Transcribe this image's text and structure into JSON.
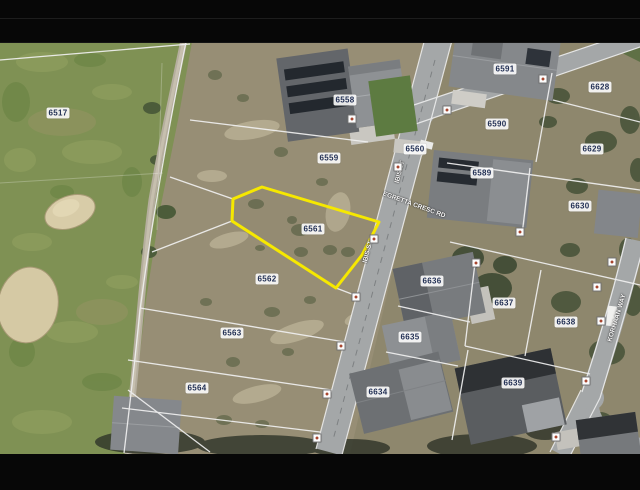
{
  "map": {
    "type": "aerial-parcel-view",
    "highlighted_parcel": "6561",
    "parcels": [
      {
        "id": "6517",
        "x": 58,
        "y": 113
      },
      {
        "id": "6558",
        "x": 345,
        "y": 100
      },
      {
        "id": "6559",
        "x": 329,
        "y": 158
      },
      {
        "id": "6560",
        "x": 415,
        "y": 149
      },
      {
        "id": "6561",
        "x": 313,
        "y": 229,
        "highlighted": true
      },
      {
        "id": "6562",
        "x": 267,
        "y": 279
      },
      {
        "id": "6563",
        "x": 232,
        "y": 333
      },
      {
        "id": "6564",
        "x": 197,
        "y": 388
      },
      {
        "id": "6589",
        "x": 482,
        "y": 173
      },
      {
        "id": "6590",
        "x": 497,
        "y": 124
      },
      {
        "id": "6591",
        "x": 505,
        "y": 69
      },
      {
        "id": "6628",
        "x": 600,
        "y": 87
      },
      {
        "id": "6629",
        "x": 592,
        "y": 149
      },
      {
        "id": "6630",
        "x": 580,
        "y": 206
      },
      {
        "id": "6634",
        "x": 378,
        "y": 392
      },
      {
        "id": "6635",
        "x": 410,
        "y": 337
      },
      {
        "id": "6636",
        "x": 432,
        "y": 281
      },
      {
        "id": "6637",
        "x": 504,
        "y": 303
      },
      {
        "id": "6638",
        "x": 566,
        "y": 322
      },
      {
        "id": "6639",
        "x": 513,
        "y": 383
      }
    ],
    "street_labels": [
      {
        "text": "EGRETTA CRESC RD",
        "x": 414,
        "y": 205,
        "angle": 20
      },
      {
        "text": "IBIS ST",
        "x": 400,
        "y": 172,
        "angle": -75
      },
      {
        "text": "IBIS ST",
        "x": 368,
        "y": 252,
        "angle": -75
      },
      {
        "text": "KORHAAN WAY",
        "x": 617,
        "y": 318,
        "angle": -73
      }
    ],
    "road_markers": [
      {
        "x": 352,
        "y": 119
      },
      {
        "x": 398,
        "y": 167
      },
      {
        "x": 374,
        "y": 239
      },
      {
        "x": 356,
        "y": 297
      },
      {
        "x": 341,
        "y": 346
      },
      {
        "x": 327,
        "y": 394
      },
      {
        "x": 317,
        "y": 438
      },
      {
        "x": 447,
        "y": 110
      },
      {
        "x": 543,
        "y": 79
      },
      {
        "x": 520,
        "y": 232
      },
      {
        "x": 612,
        "y": 262
      },
      {
        "x": 601,
        "y": 321
      },
      {
        "x": 586,
        "y": 381
      },
      {
        "x": 556,
        "y": 437
      },
      {
        "x": 476,
        "y": 263
      },
      {
        "x": 597,
        "y": 287
      }
    ],
    "colors": {
      "highlight": "#f6e800",
      "label_bg": "rgba(252,252,252,0.9)",
      "label_text": "#1f2d52",
      "road": "#a4a7a8",
      "golf_green": "#7f9154",
      "scrub": "#978e75",
      "letterbox": "#070707"
    }
  }
}
